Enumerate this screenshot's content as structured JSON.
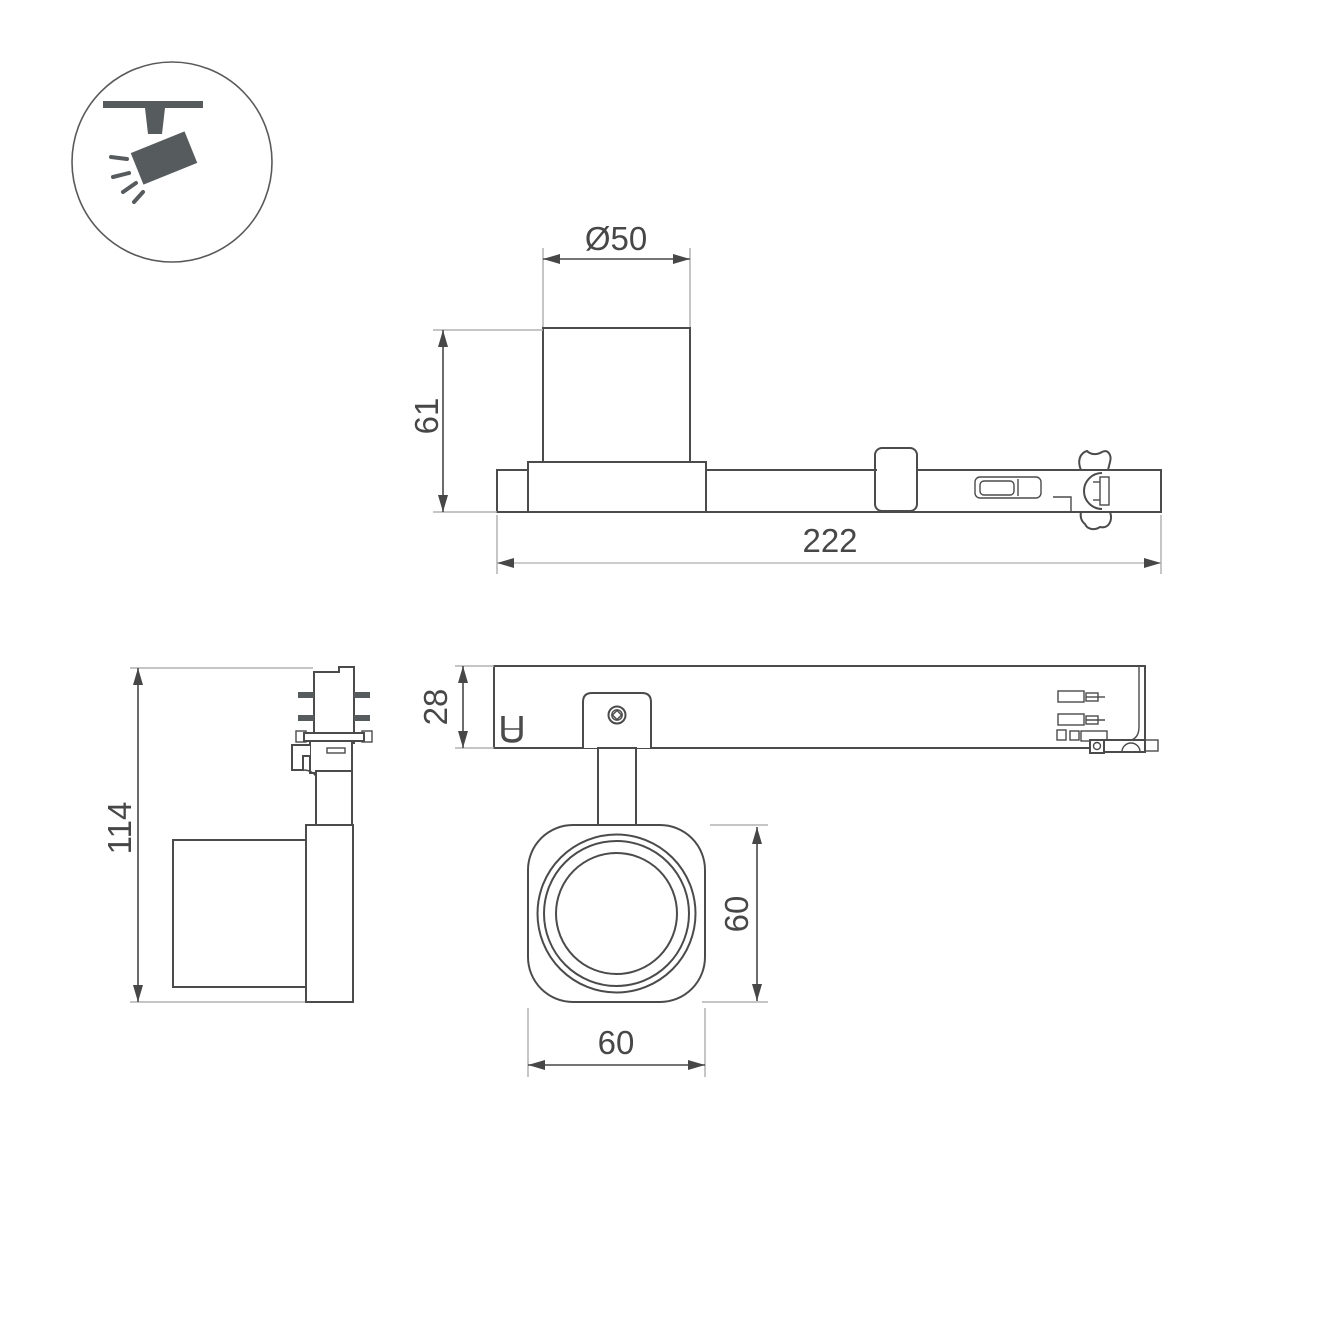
{
  "page": {
    "kind": "technical-dimension-drawing",
    "subject": "LED track spotlight fixture",
    "background": "#ffffff"
  },
  "colors": {
    "outline": "#4b4b4b",
    "dimension": "#474747",
    "extension": "#b2b2b2",
    "icon_fill": "#565b5e"
  },
  "icon": {
    "name": "track-spotlight-icon",
    "description": "ceiling track with tilted spotlight emitting rays"
  },
  "dims": {
    "d50": "Ø50",
    "h61": "61",
    "len222": "222",
    "h114": "114",
    "h28": "28",
    "w60": "60",
    "h60": "60"
  },
  "views": {
    "side_view": {
      "dimensions": [
        "Ø50",
        "61",
        "222"
      ]
    },
    "end_view": {
      "dimensions": [
        "114"
      ]
    },
    "top_view": {
      "dimensions": [
        "28"
      ]
    },
    "head_bottom_view": {
      "dimensions": [
        "60",
        "60"
      ]
    }
  }
}
